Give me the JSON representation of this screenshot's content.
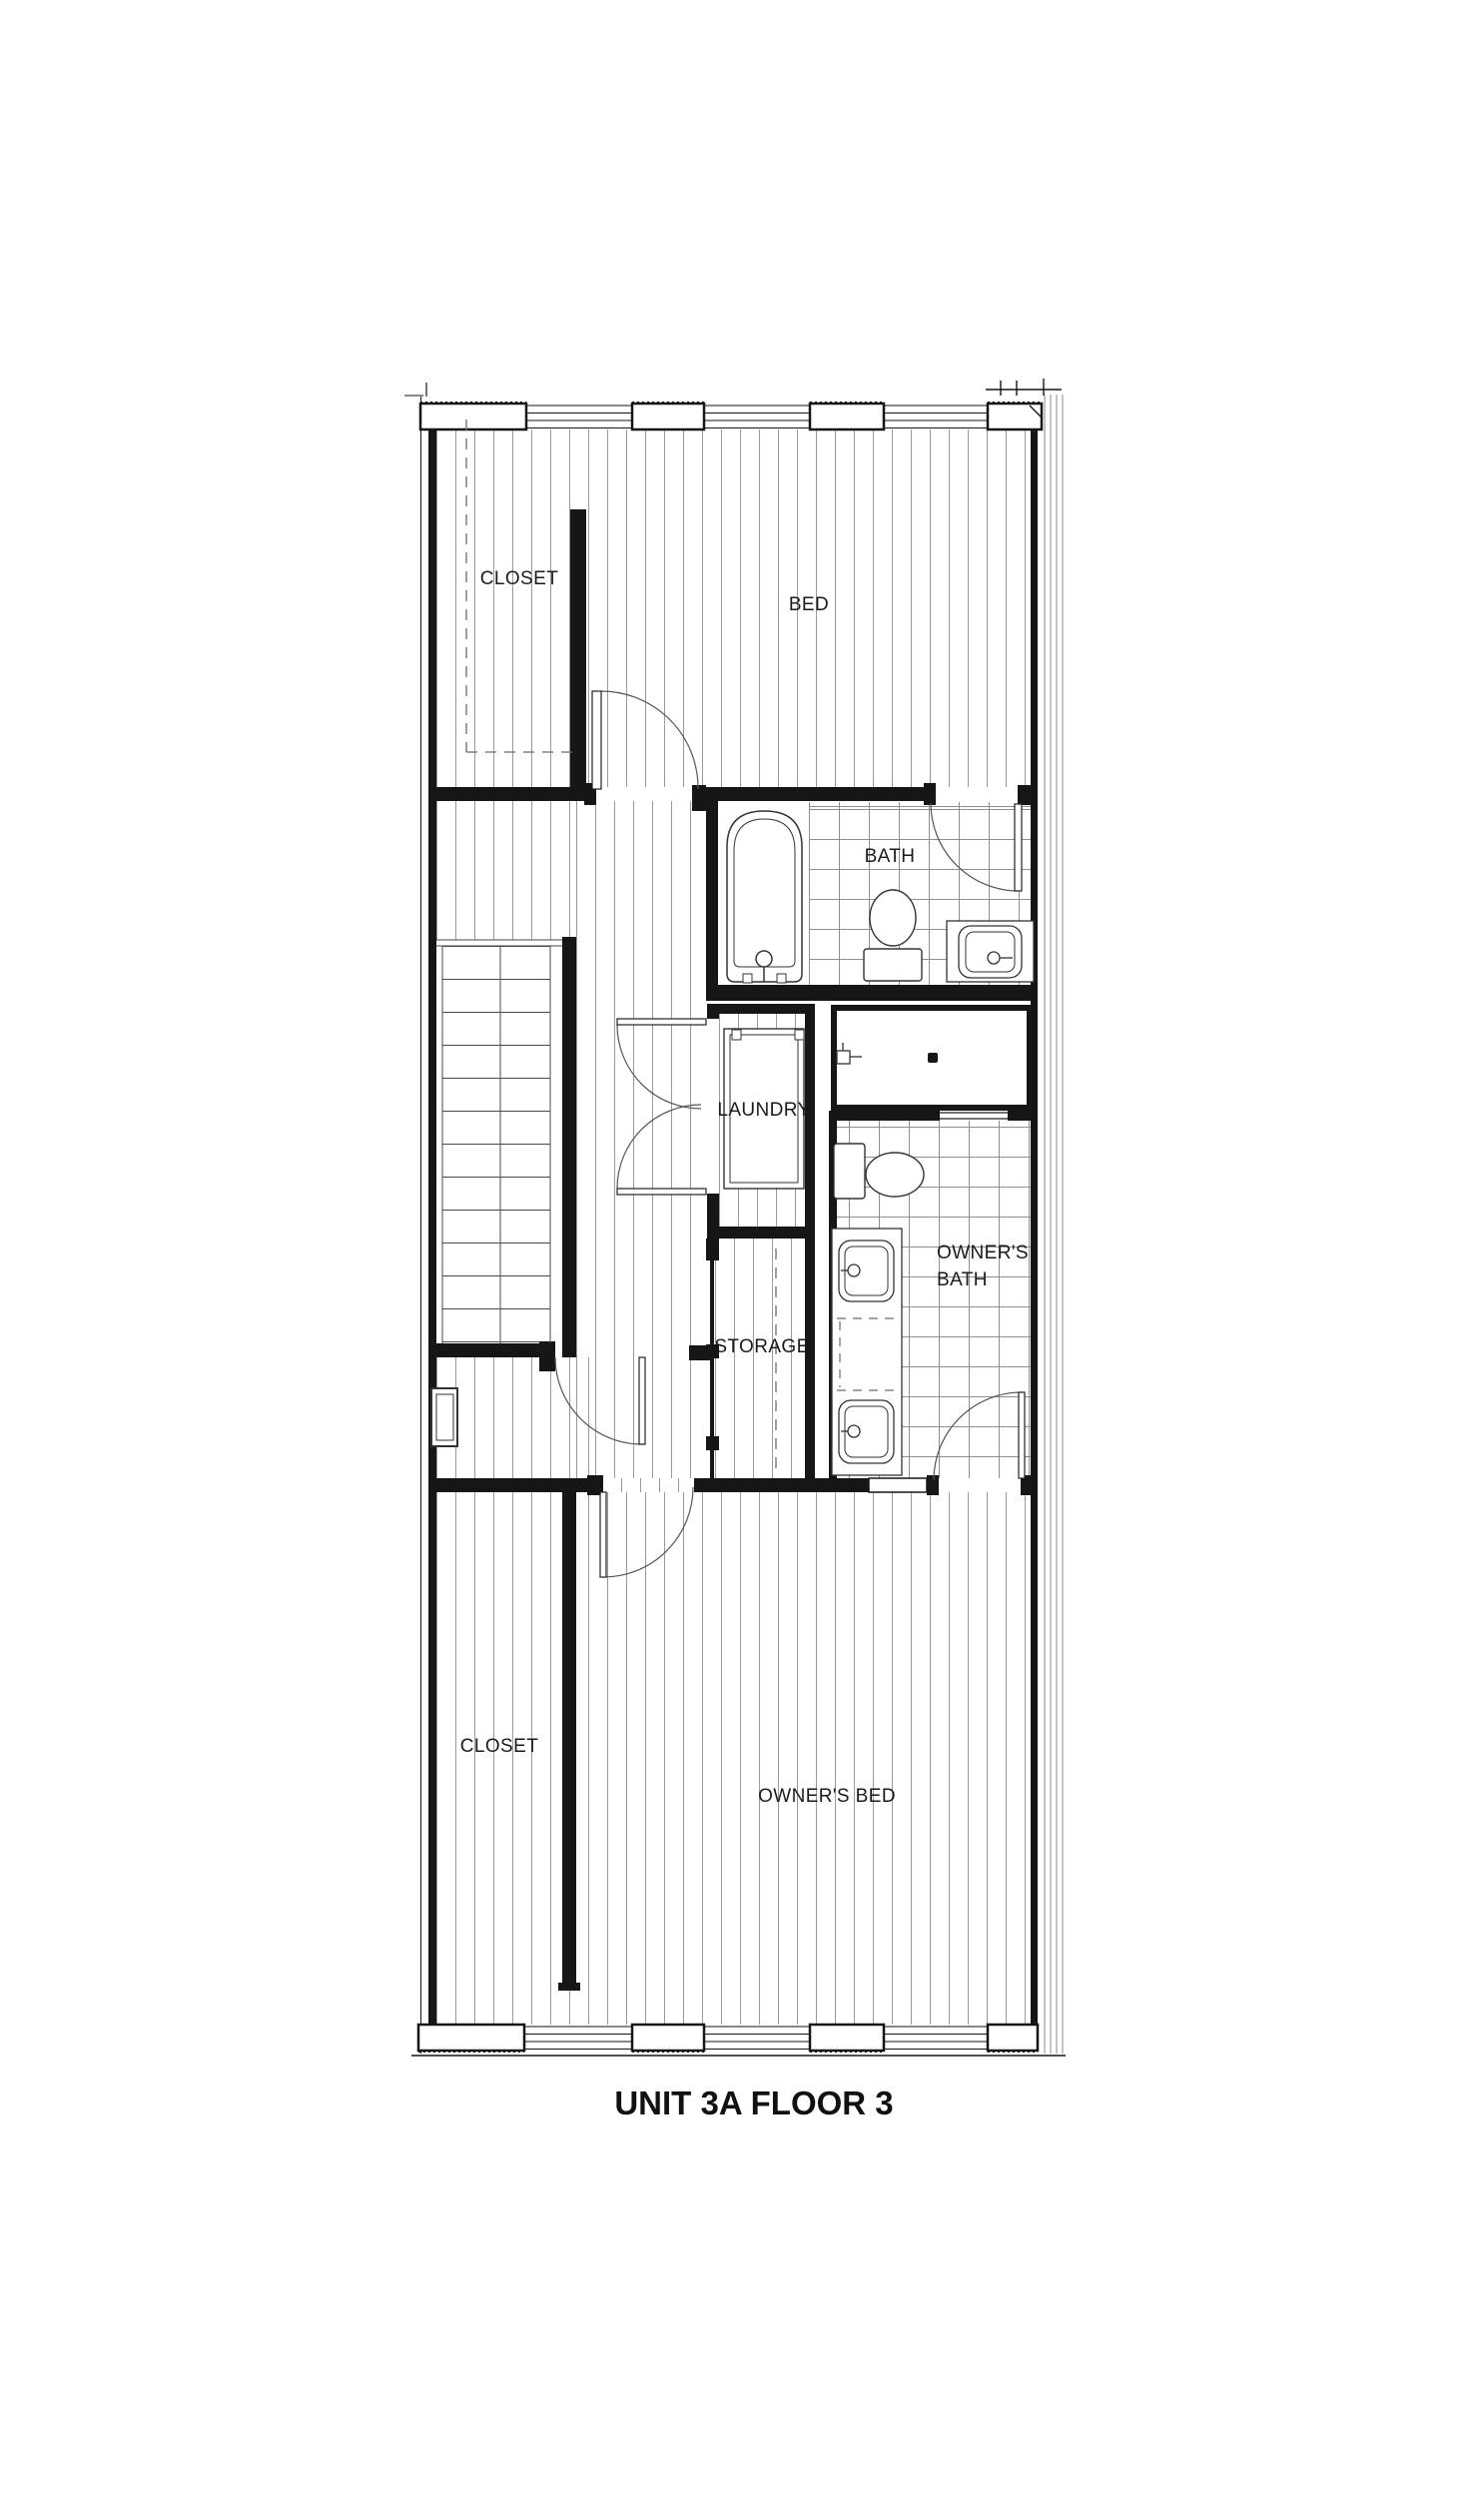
{
  "title": "UNIT 3A FLOOR 3",
  "rooms": {
    "closet_upper": "CLOSET",
    "bed": "BED",
    "bath": "BATH",
    "laundry": "LAUNDRY",
    "storage": "STORAGE",
    "owners_bath_l1": "OWNER'S",
    "owners_bath_l2": "BATH",
    "closet_lower": "CLOSET",
    "owners_bed": "OWNER'S BED"
  },
  "fixtures": [
    "bathtub",
    "toilet",
    "sink-vanity",
    "double-vanity",
    "shower",
    "washer-dryer",
    "stair"
  ],
  "colors": {
    "line": "#161616",
    "hatch": "#9a9a9a",
    "tile": "#8f8f8f",
    "arc": "#555555",
    "text": "#1b1b1b"
  }
}
